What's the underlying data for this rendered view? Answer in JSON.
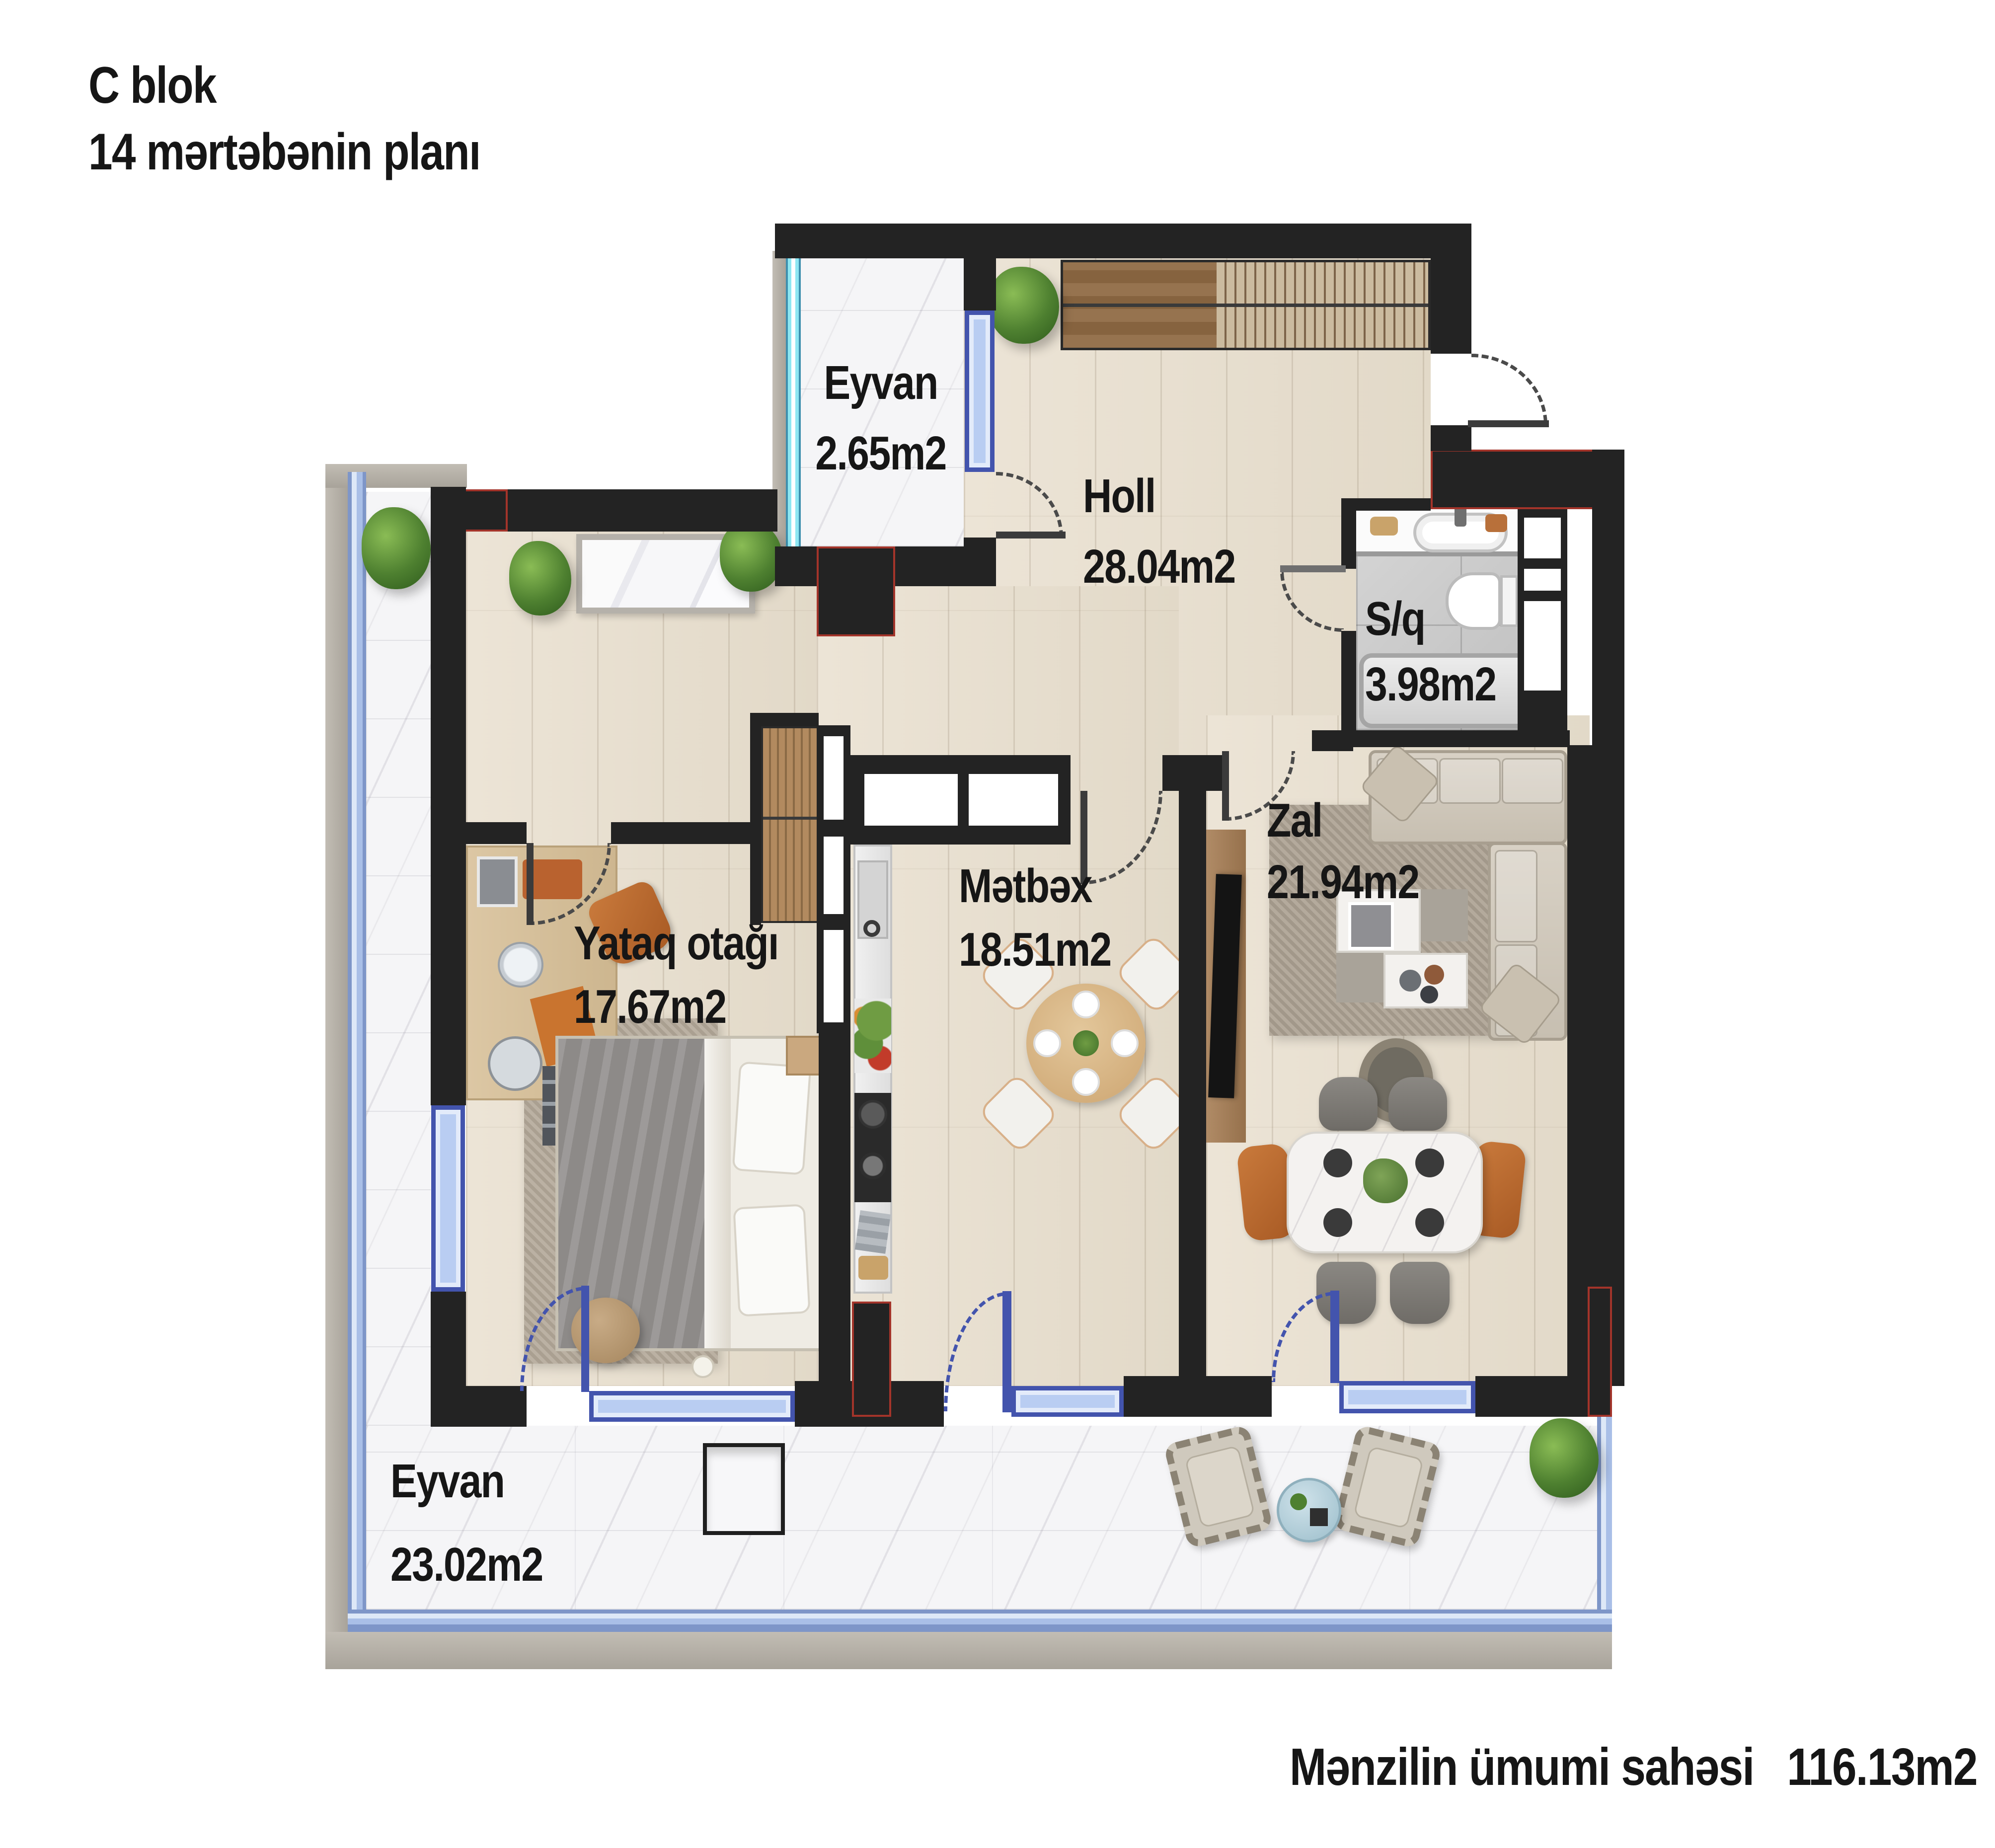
{
  "title": {
    "line1": "C blok",
    "line2": "14 mərtəbənin planı"
  },
  "rooms": {
    "eyvan_top": {
      "name": "Eyvan",
      "area": "2.65m2"
    },
    "holl": {
      "name": "Holl",
      "area": "28.04m2"
    },
    "sq": {
      "name": "S/q",
      "area": "3.98m2"
    },
    "yataq": {
      "name": "Yataq otağı",
      "area": "17.67m2"
    },
    "metbex": {
      "name": "Mətbəx",
      "area": "18.51m2"
    },
    "zal": {
      "name": "Zal",
      "area": "21.94m2"
    },
    "eyvan_bottom": {
      "name": "Eyvan",
      "area": "23.02m2"
    }
  },
  "footer": {
    "label": "Mənzilin ümumi sahəsi",
    "value": "116.13m2"
  },
  "colors": {
    "wall": "#232323",
    "window_blue": "#b9cdf2",
    "window_frame": "#4354ad",
    "window_cyan": "#8ee7f2",
    "construction_red": "#ba372c",
    "wood_floor": "#e8e0d2",
    "marble_floor": "#f5f5f7",
    "bath_tile": "#c9c9c9"
  }
}
